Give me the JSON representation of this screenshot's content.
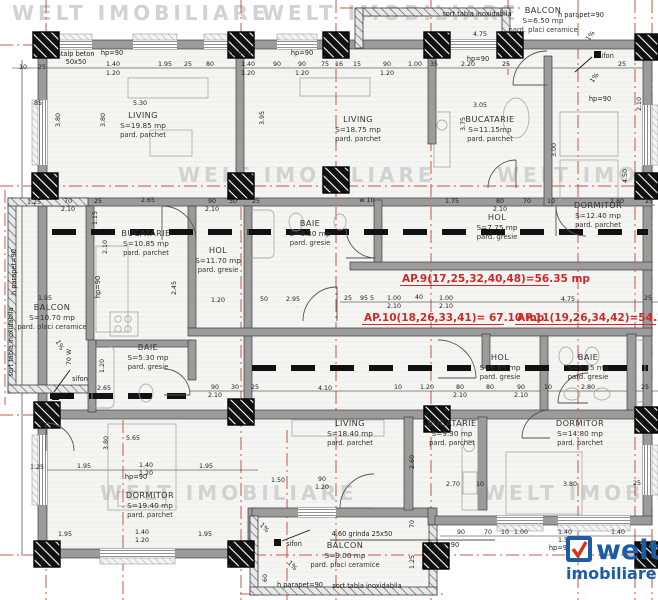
{
  "watermark": {
    "text": "WELT IMOBILIARE",
    "instances": [
      {
        "x": 12,
        "y": 20
      },
      {
        "x": 262,
        "y": 20
      },
      {
        "x": 178,
        "y": 182
      },
      {
        "x": 497,
        "y": 182
      },
      {
        "x": 100,
        "y": 500
      },
      {
        "x": 483,
        "y": 500
      }
    ]
  },
  "logo": {
    "word": "welt",
    "sub": "imobiliare",
    "check_icon": "welt-check-icon"
  },
  "colors": {
    "axis_red": "#c0392b",
    "apartment_red": "#cc2a26",
    "wall_gray": "#9b9b9b",
    "logo_blue": "#1a5da6",
    "logo_red": "#d6301e",
    "watermark": "#d2d2d2",
    "dim_text": "#1c1c1c",
    "room_text": "#333333"
  },
  "apartment_labels": [
    {
      "text": "AP.9(17,25,32,40,48)=56.35 mp",
      "x": 402,
      "y": 282,
      "ux1": 400,
      "ux2": 549
    },
    {
      "text": "AP.10(18,26,33,41)= 67.10 mp",
      "x": 364,
      "y": 321,
      "ux1": 362,
      "ux2": 504
    },
    {
      "text": "AP.11(19,26,34,42)=54.20 mp",
      "x": 517,
      "y": 321,
      "ux1": 515,
      "ux2": 656
    }
  ],
  "rooms": [
    {
      "name": "LIVING",
      "area": "S=19.85 mp",
      "floor": "pard. parchet",
      "x": 143,
      "y": 118
    },
    {
      "name": "LIVING",
      "area": "S=18.75 mp",
      "floor": "pard. parchet",
      "x": 358,
      "y": 122
    },
    {
      "name": "BUCATARIE",
      "area": "S=11.15mp",
      "floor": "pard. parchet",
      "x": 490,
      "y": 122
    },
    {
      "name": "BALCON",
      "area": "S=6.50 mp",
      "floor": "pard. placi ceramice",
      "x": 543,
      "y": 13
    },
    {
      "name": "DORMITOR",
      "area": "S=12.40 mp",
      "floor": "pard. parchet",
      "x": 598,
      "y": 208
    },
    {
      "name": "HOL",
      "area": "S=7.75 mp",
      "floor": "pard. gresie",
      "x": 497,
      "y": 220
    },
    {
      "name": "BAIE",
      "area": "S=6.30 mp",
      "floor": "pard. gresie",
      "x": 310,
      "y": 226
    },
    {
      "name": "HOL",
      "area": "S=11.70 mp",
      "floor": "pard. gresie",
      "x": 218,
      "y": 253
    },
    {
      "name": "BUCATARIE",
      "area": "S=10.85 mp",
      "floor": "pard. parchet",
      "x": 146,
      "y": 236
    },
    {
      "name": "BALCON",
      "area": "S=10.70 mp",
      "floor": "pard. placi ceramice",
      "x": 52,
      "y": 310
    },
    {
      "name": "BAIE",
      "area": "S=5.30 mp",
      "floor": "pard. gresie",
      "x": 148,
      "y": 350
    },
    {
      "name": "DORMITOR",
      "area": "S=19.40 mp",
      "floor": "pard. parchet",
      "x": 150,
      "y": 498
    },
    {
      "name": "LIVING",
      "area": "S=18.40 mp",
      "floor": "pard. parchet",
      "x": 350,
      "y": 426
    },
    {
      "name": "BUCATARIE",
      "area": "S=9.30 mp",
      "floor": "pard. parchet",
      "x": 452,
      "y": 426
    },
    {
      "name": "DORMITOR",
      "area": "S=14.80 mp",
      "floor": "pard. parchet",
      "x": 580,
      "y": 426
    },
    {
      "name": "HOL",
      "area": "S=6.65 mp",
      "floor": "pard. gresie",
      "x": 500,
      "y": 360
    },
    {
      "name": "BAIE",
      "area": "S=5.05 mp",
      "floor": "pard. gresie",
      "x": 588,
      "y": 360
    },
    {
      "name": "BALCON",
      "area": "S=9.00 mp",
      "floor": "pard. placi ceramice",
      "x": 345,
      "y": 548
    }
  ],
  "annotations": [
    [
      "stalp beton",
      76,
      56
    ],
    [
      "50x50",
      76,
      64
    ],
    [
      "sort tabla inoxidabila",
      477,
      16
    ],
    [
      "h parapet=90",
      581,
      17
    ],
    [
      "sifon",
      606,
      58
    ],
    [
      "sifon",
      80,
      381
    ],
    [
      "sifon",
      294,
      546
    ],
    [
      "hp=90",
      112,
      55
    ],
    [
      "hp=90",
      240,
      55
    ],
    [
      "hp=90",
      302,
      55
    ],
    [
      "hp=90",
      478,
      61
    ],
    [
      "hp=90",
      600,
      101
    ],
    [
      "hp=90",
      100,
      287,
      -90
    ],
    [
      "hp=90",
      136,
      479
    ],
    [
      "hp=90",
      448,
      547
    ],
    [
      "hp=90",
      560,
      550
    ],
    [
      "4.60 grinda 25x50",
      362,
      536
    ],
    [
      "h parapet=90",
      300,
      587
    ],
    [
      "sort tabla inoxidabila",
      367,
      588
    ],
    [
      "sort tabla inoxidabila",
      13,
      342,
      -90
    ],
    [
      "h parapet=90",
      16,
      272,
      -90
    ],
    [
      "1%",
      592,
      37,
      -55
    ],
    [
      "1%",
      596,
      79,
      -55
    ],
    [
      "1%",
      58,
      346,
      60
    ],
    [
      "1%",
      263,
      529,
      45
    ],
    [
      "1%",
      291,
      567,
      45
    ]
  ],
  "dimensions": [
    [
      "10",
      23,
      69
    ],
    [
      "25",
      42,
      69
    ],
    [
      "1.40",
      113,
      66
    ],
    [
      "1.20",
      113,
      75
    ],
    [
      "1.95",
      165,
      66
    ],
    [
      "25",
      188,
      66
    ],
    [
      "80",
      210,
      66
    ],
    [
      "1.40",
      248,
      66
    ],
    [
      "1.20",
      248,
      75
    ],
    [
      "90",
      277,
      66
    ],
    [
      "90",
      302,
      66
    ],
    [
      "1.20",
      302,
      75
    ],
    [
      "75",
      325,
      66
    ],
    [
      "16",
      339,
      66
    ],
    [
      "15",
      357,
      66
    ],
    [
      "90",
      387,
      66
    ],
    [
      "1.20",
      387,
      75
    ],
    [
      "1.00",
      415,
      66
    ],
    [
      "35",
      434,
      66
    ],
    [
      "2.20",
      468,
      66
    ],
    [
      "25",
      506,
      66
    ],
    [
      "25",
      622,
      66
    ],
    [
      "5.30",
      140,
      105
    ],
    [
      "3.05",
      480,
      107
    ],
    [
      "85",
      38,
      105
    ],
    [
      "4.75",
      480,
      36
    ],
    [
      "3.80",
      60,
      120,
      -90
    ],
    [
      "3.80",
      105,
      120,
      -90
    ],
    [
      "3.95",
      264,
      118,
      -90
    ],
    [
      "3.75",
      465,
      124,
      -90
    ],
    [
      "2.10",
      641,
      104,
      -90
    ],
    [
      "3.00",
      556,
      150,
      -90
    ],
    [
      "4.50",
      627,
      176,
      -90
    ],
    [
      "1.25",
      34,
      204
    ],
    [
      "70",
      68,
      203
    ],
    [
      "2.10",
      68,
      211
    ],
    [
      "25",
      98,
      203
    ],
    [
      "2.65",
      148,
      202
    ],
    [
      "90",
      212,
      203
    ],
    [
      "2.10",
      212,
      211
    ],
    [
      "30",
      233,
      203
    ],
    [
      "25",
      256,
      203
    ],
    [
      "w 10",
      367,
      202
    ],
    [
      "1.75",
      452,
      203
    ],
    [
      "80",
      500,
      203
    ],
    [
      "2.10",
      500,
      211
    ],
    [
      "70",
      527,
      203
    ],
    [
      "10",
      551,
      203
    ],
    [
      "2.80",
      617,
      203
    ],
    [
      "25",
      649,
      203
    ],
    [
      "1.15",
      97,
      218,
      -90
    ],
    [
      "2.10",
      107,
      247,
      -90
    ],
    [
      "2.45",
      176,
      288,
      -90
    ],
    [
      "1.20",
      104,
      366,
      -90
    ],
    [
      "70 W",
      71,
      357,
      -90
    ],
    [
      "1.95",
      45,
      300
    ],
    [
      "1.20",
      218,
      302
    ],
    [
      "50",
      264,
      301
    ],
    [
      "2.95",
      293,
      301
    ],
    [
      "25",
      348,
      300
    ],
    [
      "95 5",
      367,
      300
    ],
    [
      "1.00",
      394,
      300
    ],
    [
      "2.10",
      394,
      308
    ],
    [
      "40",
      419,
      299
    ],
    [
      "1.00",
      446,
      300
    ],
    [
      "2.10",
      446,
      308
    ],
    [
      "4.75",
      568,
      301
    ],
    [
      "25",
      648,
      300
    ],
    [
      "2.65",
      104,
      390
    ],
    [
      "2.10",
      104,
      398
    ],
    [
      "90",
      215,
      389
    ],
    [
      "2.10",
      215,
      397
    ],
    [
      "30",
      235,
      389
    ],
    [
      "25",
      255,
      389
    ],
    [
      "4.10",
      325,
      390
    ],
    [
      "10",
      398,
      389
    ],
    [
      "1.20",
      427,
      389
    ],
    [
      "80",
      460,
      389
    ],
    [
      "2.10",
      460,
      397
    ],
    [
      "80",
      490,
      389
    ],
    [
      "90",
      521,
      389
    ],
    [
      "2.10",
      521,
      397
    ],
    [
      "10",
      548,
      389
    ],
    [
      "2.80",
      588,
      389
    ],
    [
      "25",
      645,
      389
    ],
    [
      "5.65",
      133,
      440
    ],
    [
      "3.80",
      108,
      443,
      -90
    ],
    [
      "2.60",
      414,
      462,
      -90
    ],
    [
      "2.70",
      453,
      486
    ],
    [
      "10",
      480,
      486
    ],
    [
      "3.80",
      570,
      486
    ],
    [
      "25",
      637,
      485
    ],
    [
      "1.25",
      37,
      469
    ],
    [
      "1.95",
      84,
      468
    ],
    [
      "1.40",
      146,
      467
    ],
    [
      "1.20",
      146,
      475
    ],
    [
      "1.95",
      206,
      468
    ],
    [
      "1.50",
      278,
      482
    ],
    [
      "90",
      322,
      481
    ],
    [
      "1.20",
      322,
      489
    ],
    [
      "90",
      461,
      534
    ],
    [
      "70",
      488,
      534
    ],
    [
      "10",
      505,
      534
    ],
    [
      "1.00",
      521,
      534
    ],
    [
      "1.40",
      565,
      534
    ],
    [
      "1.50",
      565,
      542
    ],
    [
      "1.40",
      618,
      534
    ],
    [
      "70",
      414,
      524,
      -90
    ],
    [
      "1.25",
      414,
      562,
      -90
    ],
    [
      "60",
      267,
      578,
      -90
    ],
    [
      "1.95",
      65,
      536
    ],
    [
      "1.40",
      142,
      534
    ],
    [
      "1.20",
      142,
      542
    ],
    [
      "1.95",
      205,
      536
    ]
  ]
}
